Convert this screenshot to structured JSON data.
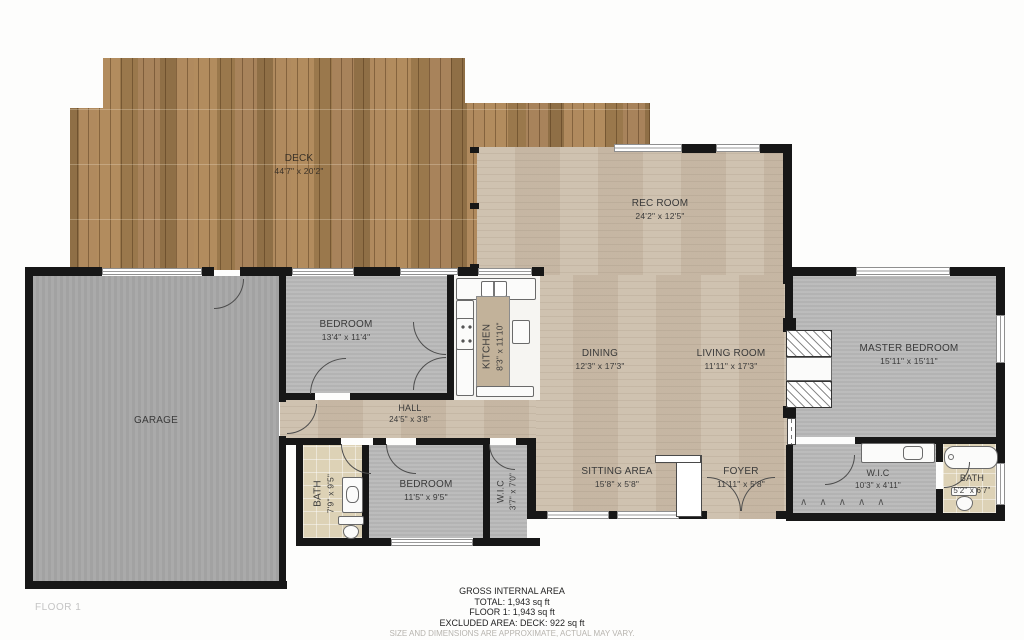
{
  "floor_label": "FLOOR 1",
  "rooms": {
    "deck": {
      "name": "DECK",
      "dims": "44'7\" x 20'2\""
    },
    "rec_room": {
      "name": "REC ROOM",
      "dims": "24'2\" x 12'5\""
    },
    "bedroom1": {
      "name": "BEDROOM",
      "dims": "13'4\" x 11'4\""
    },
    "kitchen": {
      "name": "KITCHEN",
      "dims": "8'3\" x 11'10\""
    },
    "dining": {
      "name": "DINING",
      "dims": "12'3\" x 17'3\""
    },
    "living_room": {
      "name": "LIVING ROOM",
      "dims": "11'11\" x 17'3\""
    },
    "master_bedroom": {
      "name": "MASTER BEDROOM",
      "dims": "15'11\" x 15'11\""
    },
    "garage": {
      "name": "GARAGE",
      "dims": ""
    },
    "hall": {
      "name": "HALL",
      "dims": "24'5\" x 3'8\""
    },
    "bath1": {
      "name": "BATH",
      "dims": "7'9\" x 9'5\""
    },
    "bedroom2": {
      "name": "BEDROOM",
      "dims": "11'5\" x 9'5\""
    },
    "wic1": {
      "name": "W.I.C",
      "dims": "3'7\" x 7'0\""
    },
    "sitting_area": {
      "name": "SITTING AREA",
      "dims": "15'8\" x 5'8\""
    },
    "foyer": {
      "name": "FOYER",
      "dims": "11'11\" x 5'8\""
    },
    "wic2": {
      "name": "W.I.C",
      "dims": "10'3\" x 4'11\""
    },
    "bath2": {
      "name": "BATH",
      "dims": "5'2\" x 6'7\""
    }
  },
  "summary": {
    "title": "GROSS INTERNAL AREA",
    "total": "TOTAL: 1,943 sq ft",
    "floor1": "FLOOR 1: 1,943 sq ft",
    "excluded": "EXCLUDED AREA: DECK: 922 sq ft",
    "disclaimer": "SIZE AND DIMENSIONS ARE APPROXIMATE, ACTUAL MAY VARY."
  },
  "colors": {
    "deck_wood": "#a9845a",
    "interior_wood": "#ccbeab",
    "carpet": "#b9b9b9",
    "garage_concrete": "#a7a7a7",
    "bath_tile": "#ddd2b6",
    "wall": "#171717"
  }
}
